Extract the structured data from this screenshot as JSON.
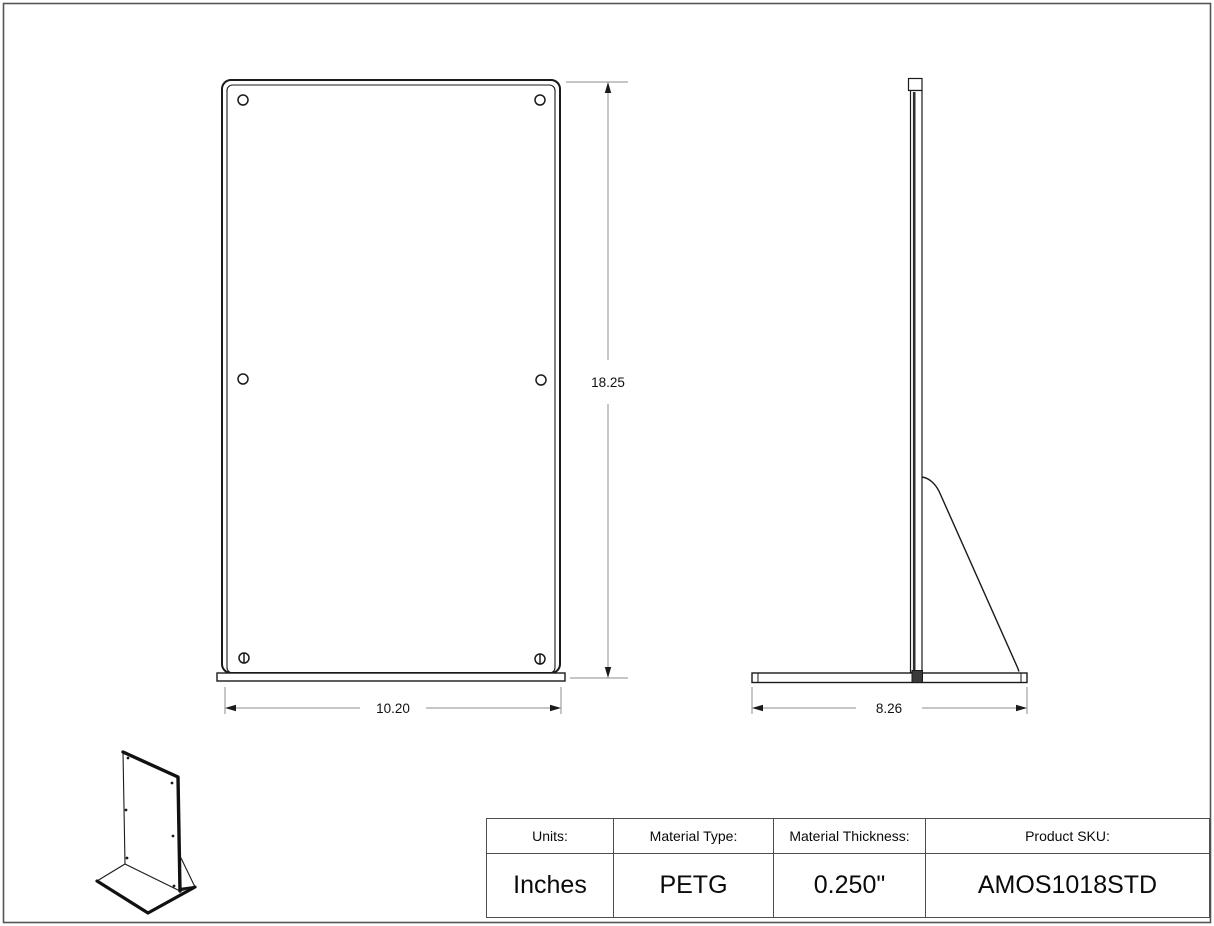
{
  "drawing": {
    "front_view": {
      "height_dim": "18.25",
      "width_dim": "10.20"
    },
    "side_view": {
      "base_dim": "8.26"
    }
  },
  "spec_table": {
    "headers": [
      "Units:",
      "Material Type:",
      "Material Thickness:",
      "Product SKU:"
    ],
    "values": [
      "Inches",
      "PETG",
      "0.250\"",
      "AMOS1018STD"
    ]
  },
  "colors": {
    "line": "#1a1a1a",
    "dim_line": "#8c8c8c",
    "table_border": "#4d4d4d",
    "page_border": "#555555"
  }
}
